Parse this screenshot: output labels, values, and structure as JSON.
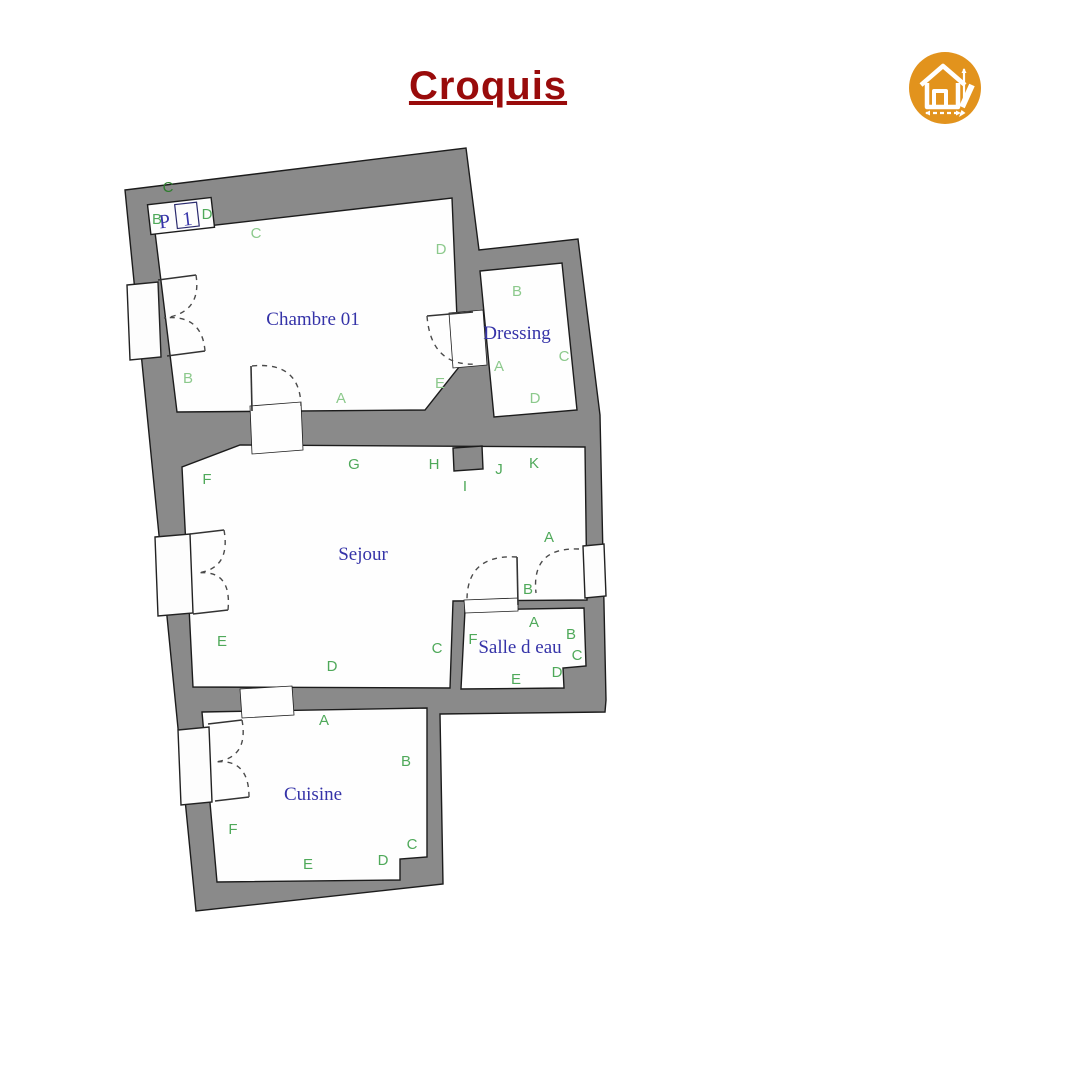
{
  "title": "Croquis",
  "colors": {
    "paper": "#ffffff",
    "wall": "#8a8a8a",
    "wall_outline": "#1c1c1c",
    "title": "#990b0b",
    "room_name": "#3533a8",
    "label_light": "#8cc98c",
    "label_mid": "#4fa95a",
    "label_dark": "#2e7d2e",
    "icon_bg": "#e2931d",
    "icon_fg": "#ffffff"
  },
  "entry": {
    "p": "P",
    "num": "1"
  },
  "rooms": [
    {
      "name": "Chambre 01",
      "x": 313,
      "y": 325
    },
    {
      "name": "Dressing",
      "x": 517,
      "y": 339
    },
    {
      "name": "Sejour",
      "x": 363,
      "y": 560
    },
    {
      "name": "Salle d eau",
      "x": 520,
      "y": 653
    },
    {
      "name": "Cuisine",
      "x": 313,
      "y": 800
    }
  ],
  "labels": [
    {
      "text": "C",
      "x": 168,
      "y": 192,
      "shade": "dark"
    },
    {
      "text": "B",
      "x": 157,
      "y": 224,
      "shade": "mid",
      "size": 12
    },
    {
      "text": "D",
      "x": 207,
      "y": 219,
      "shade": "mid"
    },
    {
      "text": "C",
      "x": 256,
      "y": 238,
      "shade": "light"
    },
    {
      "text": "D",
      "x": 441,
      "y": 254,
      "shade": "light"
    },
    {
      "text": "B",
      "x": 188,
      "y": 383,
      "shade": "light"
    },
    {
      "text": "A",
      "x": 341,
      "y": 403,
      "shade": "light"
    },
    {
      "text": "E",
      "x": 440,
      "y": 388,
      "shade": "light"
    },
    {
      "text": "B",
      "x": 517,
      "y": 296,
      "shade": "light"
    },
    {
      "text": "A",
      "x": 499,
      "y": 371,
      "shade": "light"
    },
    {
      "text": "C",
      "x": 564,
      "y": 361,
      "shade": "light"
    },
    {
      "text": "D",
      "x": 535,
      "y": 403,
      "shade": "light"
    },
    {
      "text": "F",
      "x": 207,
      "y": 484,
      "shade": "mid"
    },
    {
      "text": "G",
      "x": 354,
      "y": 469,
      "shade": "mid"
    },
    {
      "text": "H",
      "x": 434,
      "y": 469,
      "shade": "mid"
    },
    {
      "text": "I",
      "x": 465,
      "y": 491,
      "shade": "mid"
    },
    {
      "text": "J",
      "x": 499,
      "y": 474,
      "shade": "mid"
    },
    {
      "text": "K",
      "x": 534,
      "y": 468,
      "shade": "mid"
    },
    {
      "text": "A",
      "x": 549,
      "y": 542,
      "shade": "mid"
    },
    {
      "text": "B",
      "x": 528,
      "y": 594,
      "shade": "mid"
    },
    {
      "text": "E",
      "x": 222,
      "y": 646,
      "shade": "mid"
    },
    {
      "text": "D",
      "x": 332,
      "y": 671,
      "shade": "mid"
    },
    {
      "text": "C",
      "x": 437,
      "y": 653,
      "shade": "mid"
    },
    {
      "text": "A",
      "x": 534,
      "y": 627,
      "shade": "mid"
    },
    {
      "text": "F",
      "x": 473,
      "y": 644,
      "shade": "mid"
    },
    {
      "text": "B",
      "x": 571,
      "y": 639,
      "shade": "mid"
    },
    {
      "text": "C",
      "x": 577,
      "y": 660,
      "shade": "mid"
    },
    {
      "text": "D",
      "x": 557,
      "y": 677,
      "shade": "mid"
    },
    {
      "text": "E",
      "x": 516,
      "y": 684,
      "shade": "mid"
    },
    {
      "text": "A",
      "x": 324,
      "y": 725,
      "shade": "mid"
    },
    {
      "text": "B",
      "x": 406,
      "y": 766,
      "shade": "mid"
    },
    {
      "text": "F",
      "x": 233,
      "y": 834,
      "shade": "mid"
    },
    {
      "text": "E",
      "x": 308,
      "y": 869,
      "shade": "mid"
    },
    {
      "text": "D",
      "x": 383,
      "y": 865,
      "shade": "mid"
    },
    {
      "text": "C",
      "x": 412,
      "y": 849,
      "shade": "mid"
    }
  ]
}
